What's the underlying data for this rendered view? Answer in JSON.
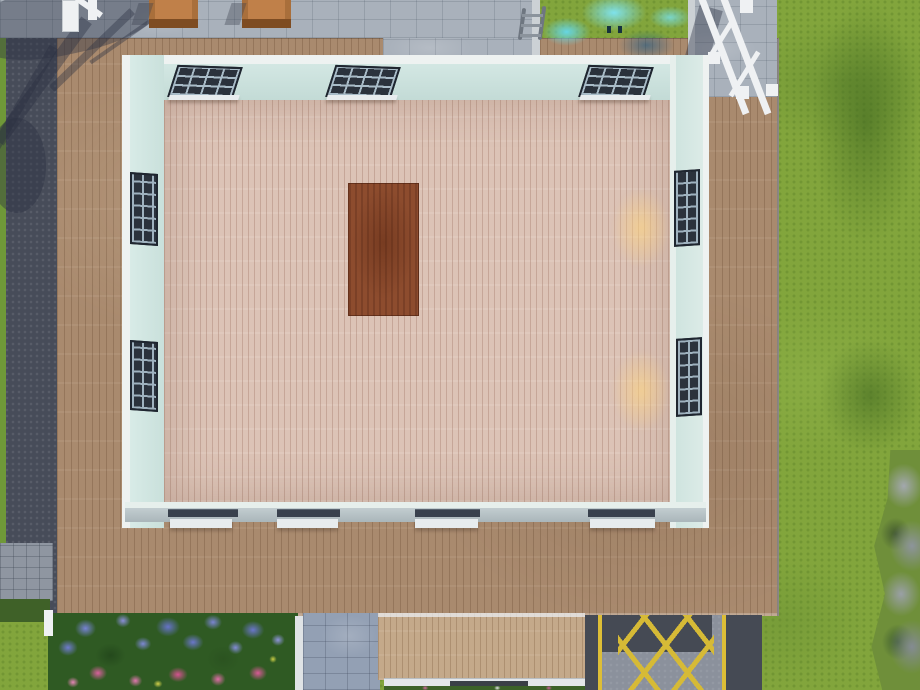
{
  "scene": {
    "title": "Top-down build-mode view of a suburban game lot: a large wooden deck surrounds an unroofed room with pale blue walls, pink plank flooring and a red-brown rug; a swimming pool and stone patio lie to the north, a street to the west, a road with yellow hatched markings to the south-east, a flower bed to the south-west, and grass with rocks to the east.",
    "view": "top-down",
    "visible_text": "none"
  },
  "labels": {
    "grass": "Grass lawn",
    "grass_dark": "Darker grass patch",
    "rocks": "Rocks and shrubs",
    "street_left": "Street (west edge)",
    "stone_patio": "Stone patio",
    "cobble": "Cobblestone corner",
    "dark_green": "Dark green lawn square",
    "pool": "Swimming pool",
    "pool_water": "Pool water",
    "pool_ladder": "Pool ladder",
    "depth_marker": "Pool depth marker",
    "deck": "Wooden deck",
    "deck_chair": "Wooden deck chair",
    "railing": "White railing",
    "tree_shadow": "Tree shadow",
    "room_floor": "Pink plank flooring",
    "wall": "Pale blue wall",
    "window": "Window",
    "window_sill": "Window sill",
    "rug": "Red-brown rug",
    "light_pool": "Warm light pool on floor",
    "flower_bed": "Flower bed with blue and pink flowers",
    "curb": "White curb strip",
    "stone_path": "Stone path",
    "porch": "Porch deck",
    "porch_step": "Porch step",
    "road": "Road with yellow hatched no-stopping zone",
    "road_line": "Yellow road line",
    "fence_post": "White fence post"
  },
  "counts": {
    "windows_top_wall": 3,
    "windows_left_wall": 2,
    "windows_right_wall": 2,
    "windows_bottom_wall": 4,
    "deck_chairs": 2,
    "light_pools": 2
  },
  "palette": {
    "grass": "#82a53c",
    "grass_dark": "#5c8530",
    "asphalt": "#474c59",
    "paving": "#a9b1bb",
    "pool_water": "#2fa9cf",
    "pool_highlight": "#7fe2ec",
    "deck_wood": "#a98a6e",
    "porch_wood": "#c4a98a",
    "interior_floor": "#dcc3b6",
    "wall": "#cfe4df",
    "wall_trim": "#eef2f1",
    "window_frame": "#2b323c",
    "bottom_wall_top": "#b6c2c6",
    "rug": "#8d4c2e",
    "flower_blue": "#7783d4",
    "flower_pink": "#d8619c",
    "road_gray": "#8b919c",
    "road_dark": "#454a54",
    "road_yellow": "#ddbe37",
    "light_glow": "#ffd682",
    "railing_white": "#eff1f3"
  }
}
